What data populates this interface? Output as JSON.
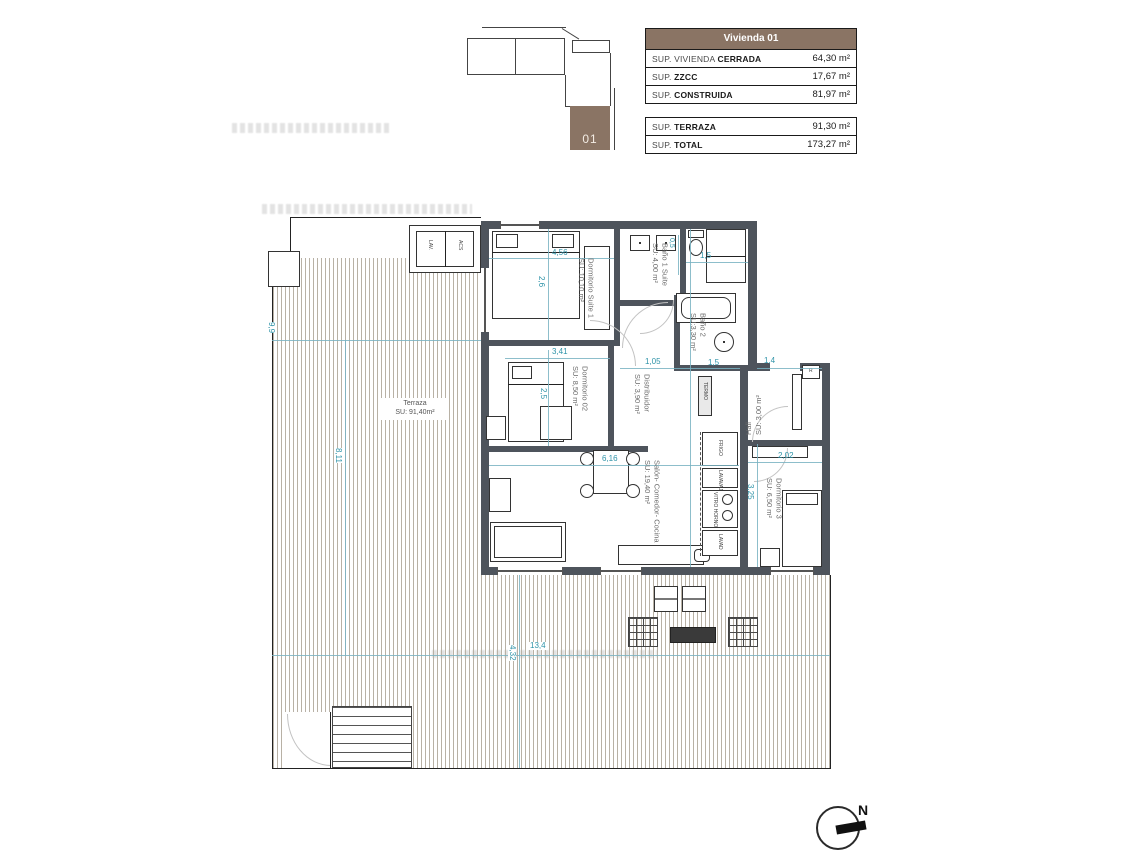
{
  "locator": {
    "unit_label": "01"
  },
  "tables": {
    "header": "Vivienda 01",
    "main_rows": [
      {
        "label_light": "SUP. VIVIENDA ",
        "label_bold": "CERRADA",
        "value": "64,30 m²"
      },
      {
        "label_light": "SUP. ",
        "label_bold": "ZZCC",
        "value": "17,67 m²"
      },
      {
        "label_light": "SUP. ",
        "label_bold": "CONSTRUIDA",
        "value": "81,97 m²"
      }
    ],
    "total_rows": [
      {
        "label_light": "SUP. ",
        "label_bold": "TERRAZA",
        "value": "91,30 m²"
      },
      {
        "label_light": "SUP. ",
        "label_bold": "TOTAL",
        "value": "173,27 m²"
      }
    ]
  },
  "plan": {
    "rooms": [
      {
        "name": "Dormitorio Suite 1",
        "area": "SU: 10,10 m²"
      },
      {
        "name": "Baño 1 Suite",
        "area": "SU: 4,00 m²"
      },
      {
        "name": "Baño 2",
        "area": "SU:3,30 m²"
      },
      {
        "name": "Dormitorio 02",
        "area": "SU: 8,50 m²"
      },
      {
        "name": "Distribuidor",
        "area": "SU: 3,90 m²"
      },
      {
        "name": "Hall",
        "area": "SU: 3,00 m²"
      },
      {
        "name": "Salón- Comedor- Cocina",
        "area": "SU: 19,40 m²"
      },
      {
        "name": "Dormitorio 3",
        "area": "SU: 6,50 m²"
      }
    ],
    "terrace": {
      "name": "Terraza",
      "area": "SU: 91,40m²"
    },
    "dims": [
      "4,56",
      "2,6",
      "0,5",
      "1,5",
      "3,41",
      "2,5",
      "1,05",
      "1,5",
      "1,4",
      "2,02",
      "3,25",
      "6,16",
      "13,4",
      "4,32",
      "8,11",
      "9,9"
    ],
    "closets": {
      "lav": "LAV.",
      "acs": "ACS"
    },
    "kitchen_labels": [
      "FRIGO",
      "LAVAVAJ",
      "VITRO HORNO",
      "LAVAD"
    ],
    "misc_labels": {
      "register": "R",
      "termo": "TERMO"
    }
  },
  "compass": {
    "north": "N"
  },
  "colors": {
    "accent_brown": "#8a7464",
    "wall_gray": "#4e545c",
    "dimension_teal": "#2e93a8",
    "hatch_tan": "#b8b1a5"
  }
}
